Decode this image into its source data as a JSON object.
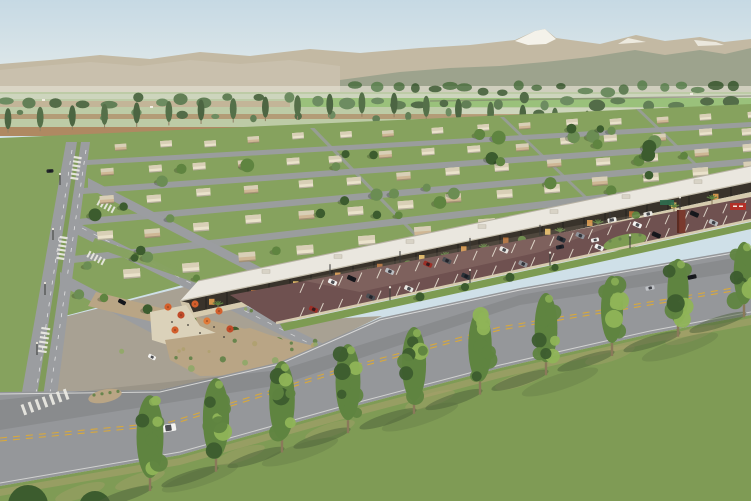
{
  "scene": {
    "kind": "aerial-architectural-rendering",
    "description": "Daytime aerial rendering of a master-planned desert community: distant snow-capped mountain range, farmland with orchards, a poplar windbreak row, a grid of flat-roofed single-story homes with lawns and street trees, a long retail strip with white roof, dark colonnade storefronts, palm trees and orange patio umbrellas, an angled-stall parking lot with cars, a diagonal boulevard with dashed yellow centerline, and a foreground row of tall trees on grass casting long shadows.",
    "colors": {
      "sky_top": "#c6d9e4",
      "sky_horizon": "#eaefec",
      "mountain_far": "#c3b9a3",
      "mountain_haze": "#cbc3b0",
      "mountain_near": "#9ba18c",
      "snow": "#f4f2ea",
      "haze": "#dcd8c8",
      "field_green": "#b9c7a0",
      "field_pale": "#ccd3ba",
      "field_tan": "#c0aa8d",
      "field_brown": "#a98057",
      "field_bright": "#8fbb6b",
      "orchard_dark": "#46613b",
      "orchard_mid": "#57764a",
      "orchard_light": "#628455",
      "poplar": "#49663c",
      "poplar_dark": "#3f5a34",
      "trunk": "#8a795a",
      "lawn": "#86a25e",
      "road": "#9b9da0",
      "paved": "#a8a193",
      "median_green": "#7d9b52",
      "median_dirt": "#b9a585",
      "house_wall": "#eae2cb",
      "house_roof": "#d8cfb6",
      "house_tan": "#cfb795",
      "strip_roof": "#eae7df",
      "strip_roof_edge": "#b8b2a4",
      "canopy": "#39332b",
      "storefront_warm": "#d99a4e",
      "storefront_amber": "#e8c06a",
      "storefront_brown": "#b4713a",
      "column": "#27231f",
      "sidewalk": "#d6cbae",
      "plaza": "#dbd2ba",
      "umbrella_1": "#d35f2c",
      "umbrella_2": "#c04a28",
      "umbrella_3": "#e07a38",
      "palm": "#5d8040",
      "parking": "#6f5150",
      "parking_worn": "#d9c8b0",
      "parking_stripe": "#ece6d8",
      "boulevard": "#95979a",
      "yellow_line": "#d7a83d",
      "white_line": "#e9e9e7",
      "grass": "#7f9b55",
      "grass_tan": "#b0a171",
      "grass_shadow": "#4c6039",
      "tree_dark": "#3c5c2e",
      "tree_mid": "#5f8440",
      "tree_light": "#8fb457",
      "shrub": "#93a86b",
      "shrub_dark": "#69854d",
      "pylon": "#7a3a2e",
      "sign_red": "#b23028",
      "sign_green": "#2f6e4f",
      "car_palette": [
        "#f4f4f2",
        "#17181c",
        "#babdc1",
        "#9c2f27",
        "#4c4e53",
        "#e8e6e1",
        "#2a3138",
        "#8f9298"
      ]
    },
    "counts": {
      "mid_poplars": 24,
      "house_rows": 5,
      "houses_approx": 68,
      "residential_trees": 48,
      "palms_and_street_trees": 14,
      "parked_cars": 18,
      "aisle_cars": 2,
      "boulevard_cars": 4,
      "street_cars": 3,
      "umbrellas": 7,
      "lamp_posts": 12,
      "foreground_trees": 10
    },
    "elements": [
      "sky",
      "mountain-range-with-snow-peak",
      "farmland-strips",
      "orchard-tree-clusters",
      "poplar-windbreak-row",
      "residential-district",
      "street-grid",
      "retail-strip",
      "patio-umbrella-plaza",
      "parking-lot-with-cars",
      "monument-pylon-sign",
      "boulevard-with-yellow-centerline",
      "crosswalks",
      "foreground-tree-row"
    ]
  }
}
